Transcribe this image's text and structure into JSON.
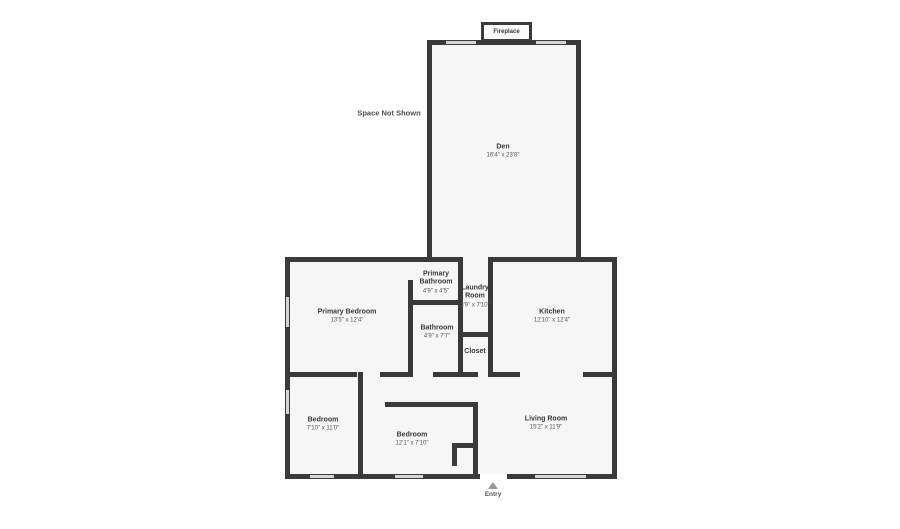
{
  "title": "Floor plan",
  "colors": {
    "wall": "#3a3a3a",
    "floor": "#f6f6f6",
    "window": "#d6d6d6",
    "background": "#ffffff"
  },
  "annotations": {
    "fireplace": "Fireplace",
    "space_not_shown": "Space Not Shown",
    "entry": "Entry"
  },
  "rooms": {
    "den": {
      "name": "Den",
      "dims": "16'4\" x 23'8\""
    },
    "primary_bedroom": {
      "name": "Primary Bedroom",
      "dims": "13'5\" x 12'4\""
    },
    "primary_bathroom": {
      "name": "Primary Bathroom",
      "dims": "4'9\" x 4'5\""
    },
    "laundry_room": {
      "name": "Laundry Room",
      "dims": "3'9\" x 7'10\""
    },
    "kitchen": {
      "name": "Kitchen",
      "dims": "12'10\" x 12'4\""
    },
    "bathroom": {
      "name": "Bathroom",
      "dims": "4'9\" x 7'7\""
    },
    "closet": {
      "name": "Closet"
    },
    "bedroom_left": {
      "name": "Bedroom",
      "dims": "7'10\" x 11'0\""
    },
    "bedroom_middle": {
      "name": "Bedroom",
      "dims": "12'1\" x 7'10\""
    },
    "living_room": {
      "name": "Living Room",
      "dims": "15'2\" x 11'9\""
    }
  }
}
